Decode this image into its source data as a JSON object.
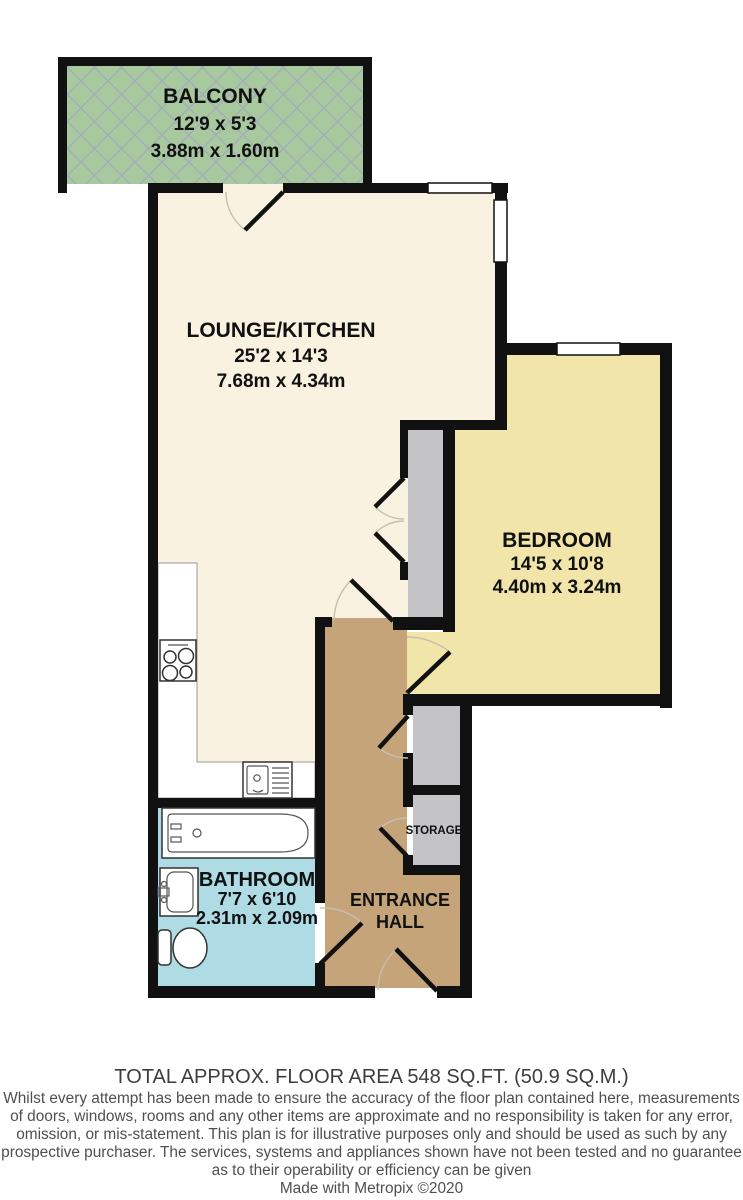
{
  "rooms": {
    "balcony": {
      "name": "BALCONY",
      "imperial": "12'9 x 5'3",
      "metric": "3.88m x 1.60m"
    },
    "lounge_kitchen": {
      "name": "LOUNGE/KITCHEN",
      "imperial": "25'2 x 14'3",
      "metric": "7.68m x 4.34m"
    },
    "bedroom": {
      "name": "BEDROOM",
      "imperial": "14'5 x 10'8",
      "metric": "4.40m x 3.24m"
    },
    "bathroom": {
      "name": "BATHROOM",
      "imperial": "7'7 x 6'10",
      "metric": "2.31m x 2.09m"
    },
    "entrance_hall": {
      "name_line1": "ENTRANCE",
      "name_line2": "HALL"
    },
    "storage": {
      "name": "STORAGE"
    }
  },
  "colors": {
    "lounge_cream": "#faf2e0",
    "bedroom_yellow": "#f1e5a9",
    "hall_tan": "#c5a47a",
    "bathroom_blue": "#aedbe4",
    "storage_gray": "#c4c4c6",
    "balcony_green": "#a8c89e",
    "wall_black": "#111111"
  },
  "footer": {
    "total_area": "TOTAL APPROX. FLOOR AREA 548 SQ.FT. (50.9 SQ.M.)",
    "disclaimer_lines": [
      "Whilst every attempt has been made to ensure the accuracy of the floor plan contained here, measurements",
      "of doors, windows, rooms and any other items are approximate and no responsibility is taken for any error,",
      "omission, or mis-statement. This plan is for illustrative purposes only and should be used as such by any",
      "prospective purchaser. The services, systems and appliances shown have not been tested and no guarantee",
      "as to their operability or efficiency can be given",
      "Made with Metropix ©2020"
    ]
  }
}
